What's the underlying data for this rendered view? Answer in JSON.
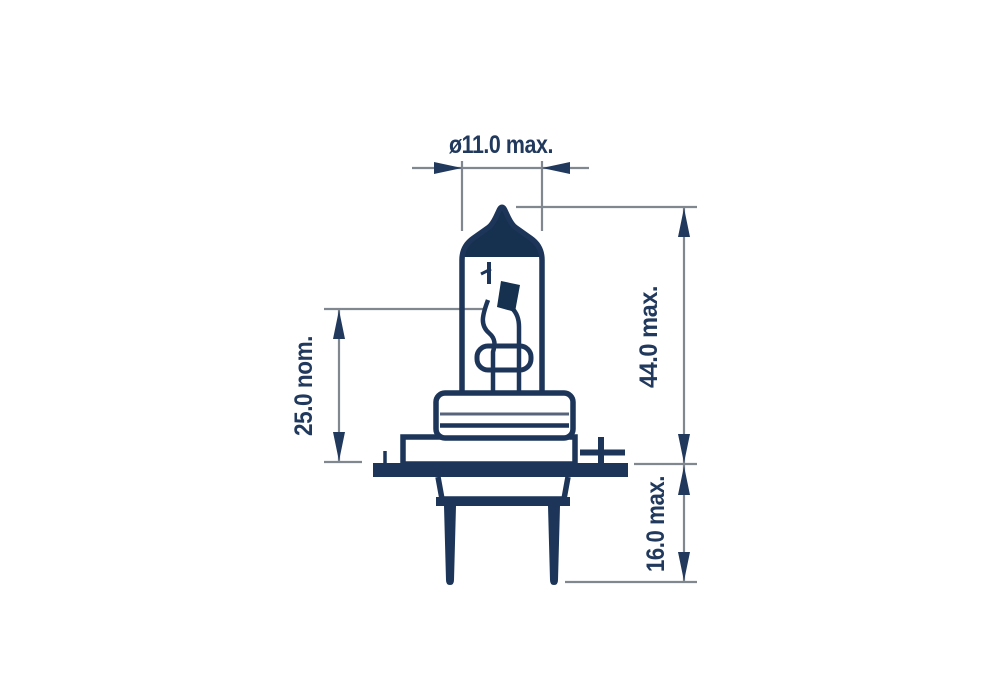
{
  "drawing": {
    "title": "Halogen headlamp bulb dimensional drawing",
    "labels": {
      "diameter": "ø11.0 max.",
      "overall_length": "44.0 max.",
      "pin_depth": "16.0 max.",
      "light_center": "25.0 nom."
    },
    "colors": {
      "outline_navy": "#1c3558",
      "dome_fill_navy": "#16304f",
      "dimension_line_gray": "#81878f",
      "label_text_navy": "#21395c",
      "background": "#ffffff"
    }
  }
}
